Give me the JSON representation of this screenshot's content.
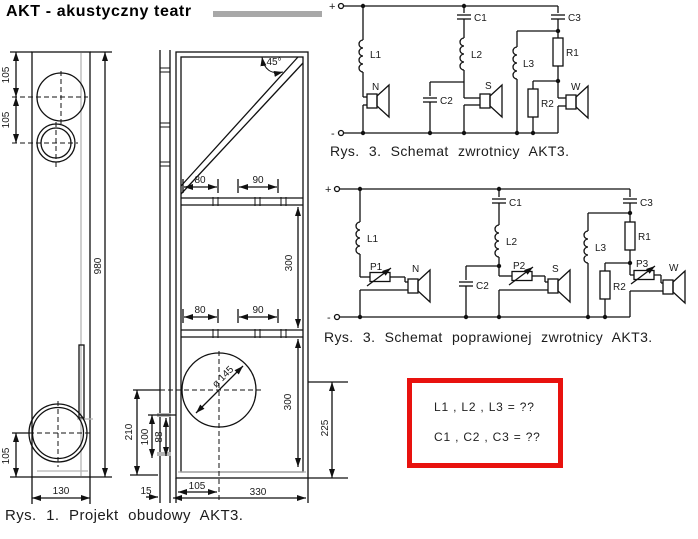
{
  "title": "AKT - akustyczny teatr",
  "captions": {
    "fig3a": "Rys. 3. Schemat zwrotnicy AKT3.",
    "fig3b": "Rys. 3. Schemat poprawionej zwrotnicy AKT3.",
    "fig1": "Rys. 1. Projekt obudowy AKT3."
  },
  "note_box": {
    "line1": "L1 , L2 , L3 = ??",
    "line2": "C1 , C2 , C3 = ??"
  },
  "colors": {
    "box_red": "#e8120e",
    "bar_gray": "#a8a8a8",
    "panel_gray": "#b5b5b5"
  },
  "schematic1": {
    "plus": "+",
    "minus": "-",
    "l1": "L1",
    "l2": "L2",
    "l3": "L3",
    "c1": "C1",
    "c2": "C2",
    "c3": "C3",
    "r1": "R1",
    "r2": "R2",
    "n": "N",
    "s": "S",
    "w": "W"
  },
  "schematic2": {
    "plus": "+",
    "minus": "-",
    "l1": "L1",
    "l2": "L2",
    "l3": "L3",
    "c1": "C1",
    "c2": "C2",
    "c3": "C3",
    "r1": "R1",
    "r2": "R2",
    "p1": "P1",
    "p2": "P2",
    "p3": "P3",
    "n": "N",
    "s": "S",
    "w": "W"
  },
  "cab": {
    "side": {
      "d105_top": "105",
      "d105_mid": "105",
      "d980": "980",
      "d105_bottom": "105",
      "d130": "130"
    },
    "front": {
      "angle": "45°",
      "top80": "80",
      "top90": "90",
      "mid80": "80",
      "mid90": "90",
      "v300_upper": "300",
      "v300_lower": "300",
      "v225": "225",
      "v210": "210",
      "v100": "100",
      "v88": "88",
      "dia": "ø 145",
      "d15": "15",
      "d105": "105",
      "d330": "330"
    }
  }
}
